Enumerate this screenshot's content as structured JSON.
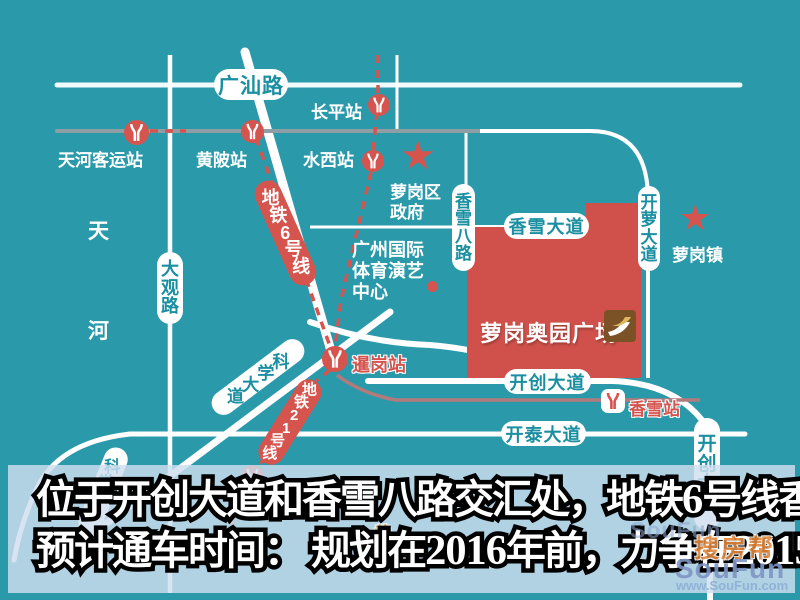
{
  "colors": {
    "background_teal": "#2a9aab",
    "metro_red": "#d6544e",
    "plaza_red": "#d0514b",
    "capsule_text_teal": "#1a8fa1",
    "gray_road": "#8d9ea4",
    "rose_line": "#b27a7a",
    "watermark_orange": "#e0873c",
    "watermark_blue": "#7f95c5"
  },
  "roads": {
    "guangshan": "广汕路",
    "daguan": "大观路",
    "kexue1": "科学大道",
    "kexue2": "科学大道",
    "xiangxue8": "香雪八路",
    "xiangxue_ave": "香雪大道",
    "kailuo": "开萝大道",
    "kaichuang_h": "开创大道",
    "kaitai": "开泰大道",
    "kaichuang_v": "开创大道"
  },
  "metro_lines": {
    "line6": "地铁6号线",
    "line21": "地铁21号线"
  },
  "stations": {
    "tianhe_keyun": "天河客运站",
    "huangpi": "黄陂站",
    "changping": "长平站",
    "shuixi": "水西站",
    "xiagang": "暹岗站",
    "xiangxue": "香雪站",
    "suyuan": "苏元站"
  },
  "places": {
    "district_gov_line1": "萝岗区",
    "district_gov_line2": "政府",
    "luogang_town": "萝岗镇",
    "tianhe_area": "天河",
    "arena_line1": "广州国际",
    "arena_line2": "体育演艺",
    "arena_line3": "中心",
    "plaza": "萝岗奥园广场",
    "map_fragment": "黄"
  },
  "banner": {
    "line1": {
      "a": "位于开创大道和香雪八路交汇处，地铁",
      "b": "6",
      "c": "号线香雪站上盖"
    },
    "line2": {
      "a": "预计通车时间： 规划在",
      "b": "2016",
      "c": "年前，力争在",
      "d": "2015",
      "e": "年左右通车"
    }
  },
  "watermark": {
    "ghost": "SouFun",
    "brand_cn": "搜房帮",
    "brand_en": "SouFun",
    "url": "www.SouFun.com"
  }
}
